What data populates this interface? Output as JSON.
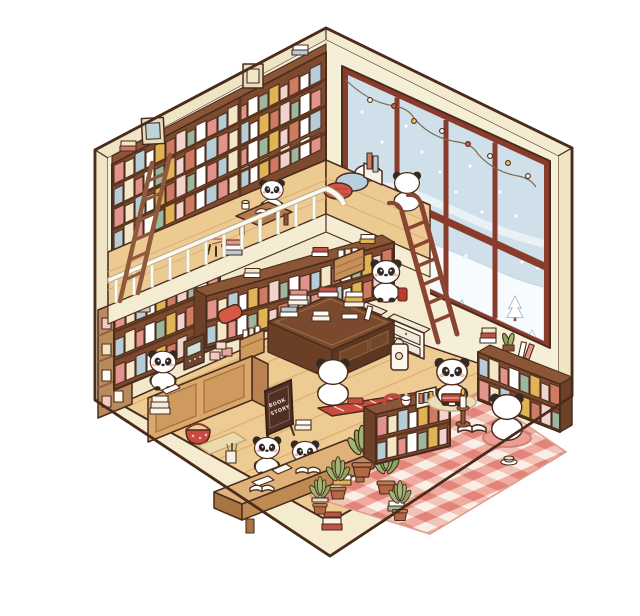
{
  "scene": {
    "title": "Cozy panda bookstore — isometric cutaway illustration",
    "description": "A hexagonal isometric cutaway of a two-level bookstore run by cartoon pandas. A tall book wall with wooden ladders lines the left wall, a loft reading mezzanine with a white railing overlooks the shop, and a large paned window on the right shows falling snow, drifts and pine trees. On the shop floor pandas read at desks, browse a book display table, and mind the checkout counter among plants, gingham rugs and stacks of books.",
    "sign": {
      "lines": [
        "BOOK",
        "STORY"
      ]
    },
    "panda_count": 9,
    "pandas": [
      {
        "name": "loft-reader",
        "pose": "reading at a low table on the mezzanine"
      },
      {
        "name": "loft-sitter",
        "pose": "sitting at the loft edge watching the snow"
      },
      {
        "name": "ladder-browser",
        "pose": "standing by the loft ladder holding a red book"
      },
      {
        "name": "cashier",
        "pose": "standing behind the checkout counter"
      },
      {
        "name": "floor-browser",
        "pose": "sitting on the floor beside the display table"
      },
      {
        "name": "desk-reader-1",
        "pose": "reading at the long study desk"
      },
      {
        "name": "desk-reader-2",
        "pose": "reading at the long study desk"
      },
      {
        "name": "nook-reader",
        "pose": "sitting on a beige cushion with a red book"
      },
      {
        "name": "nook-companion",
        "pose": "sitting on a pink cushion with an open book"
      }
    ],
    "furniture": [
      "tall book wall with two ladders",
      "loft mezzanine with white railing",
      "low reading table",
      "red stool",
      "book display table",
      "long waist-high bookshelf",
      "checkout counter with register",
      "A-frame shop sign",
      "long study desk",
      "two low bookcases in the reading nook",
      "card display rack",
      "white storage cubbies"
    ],
    "props": [
      "string lights",
      "floor cushions",
      "gingham rug",
      "red runner rug",
      "potted plants",
      "candlestick",
      "teacup",
      "tote bag",
      "book baskets",
      "stacked books",
      "picture frames"
    ],
    "window": {
      "weather": "falling snow",
      "view": "snow drifts and pine trees",
      "decor": "string lights"
    },
    "palette": {
      "background": "#ffffff",
      "wall_cream": "#f6efd7",
      "wood_dark": "#7b4a2e",
      "wood_mid": "#c08a54",
      "floor_wood": "#eecb93",
      "window_frame": "#8a3c2c",
      "sky_blue": "#cfe0ea",
      "snow_white": "#f7fbfd",
      "gingham_red": "#e99287",
      "accent_red": "#c84a40",
      "panda_black": "#332a24",
      "plant_green": "#9fb573"
    }
  }
}
